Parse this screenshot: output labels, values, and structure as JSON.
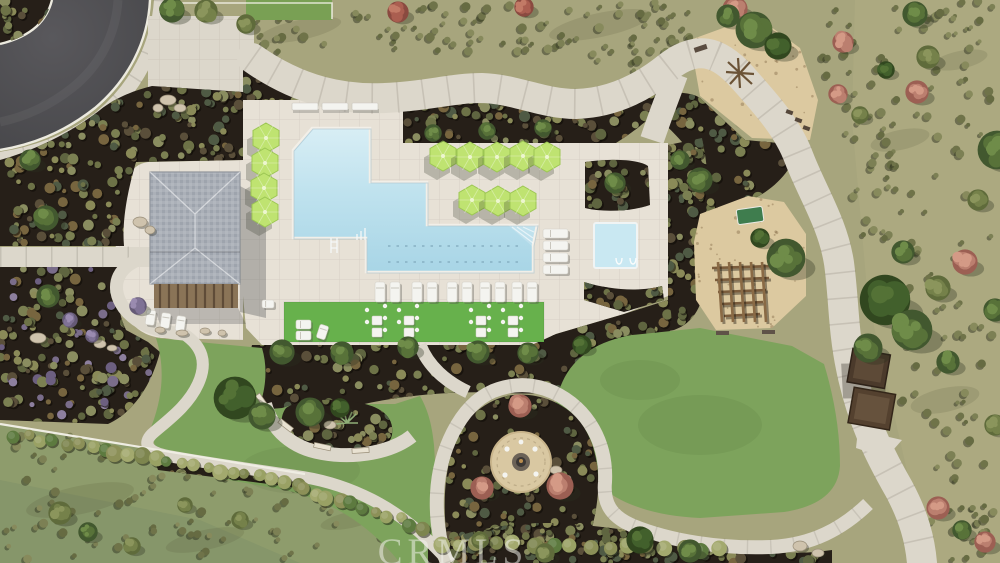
{
  "watermark": {
    "text": "CRMLS"
  },
  "scene": {
    "title": "Community amenity area - aerial site plan rendering",
    "setting": "Overhead 3D architectural rendering of a neighborhood recreation center",
    "features": [
      {
        "name": "swimming-pool",
        "label": "L-shaped swimming pool with two dashed lap lanes and entry steps"
      },
      {
        "name": "spa",
        "label": "Square spa with two handrails beside the lap pool"
      },
      {
        "name": "pool-deck",
        "label": "Light travertine pool deck"
      },
      {
        "name": "cabana",
        "label": "Pool building with gray hip roof and wood pergola"
      },
      {
        "name": "umbrellas",
        "label": "Lime-green hexagonal patio umbrellas",
        "count": 12
      },
      {
        "name": "lounge-chairs",
        "label": "White chaise lounges, benches and cafe tables"
      },
      {
        "name": "turf-lounge",
        "label": "Bright artificial-turf seating strip with white furniture"
      },
      {
        "name": "playground-upper",
        "label": "Wood-chip tot lot with play equipment"
      },
      {
        "name": "playground-lower",
        "label": "Wood-chip playground with log climbing structure and green game table"
      },
      {
        "name": "fire-pit",
        "label": "Round decomposed-granite fire pit plaza flanked by pink trees"
      },
      {
        "name": "seating-island",
        "label": "Half-ring walkway around planted island with benches"
      },
      {
        "name": "shade-structure",
        "label": "Two brown shade canopies beside the east walkway"
      },
      {
        "name": "lawns",
        "label": "Open green lawns"
      },
      {
        "name": "walkways",
        "label": "Curving concrete walkways with score joints"
      },
      {
        "name": "street",
        "label": "Asphalt street corner with white curb, corner planter and sidewalk"
      },
      {
        "name": "planting-beds",
        "label": "Dark mulch planting beds densely dotted with shrubs"
      },
      {
        "name": "meadow",
        "label": "Olive open space with scattered shrubs, green and pink trees"
      },
      {
        "name": "boundary-fence",
        "label": "Thin white boundary fence with shrub hedge row"
      }
    ]
  },
  "palette": {
    "meadow": "#a7a57d",
    "meadow_green": "#8e9c6c",
    "lawn": "#7da35c",
    "turf": "#67b14c",
    "mulch": "#261f18",
    "deck": "#e7e1d6",
    "path": "#dcd7cb",
    "road": "#4c4b4d",
    "curb": "#eceadf",
    "water_top": "#d8eef5",
    "water_deep": "#a8d5e6",
    "spa_water": "#c9e8f2",
    "sand": "#dcc9a0",
    "umbrella": "#bfe371",
    "umbrella_edge": "#9cc653",
    "roof": "#a7adb4",
    "roof_dark": "#9399a2",
    "pergola": "#8a7457",
    "furniture": "#f4f4f0",
    "fence": "#efede3",
    "fire_plaza": "#d9c8a2",
    "watermark_color": "rgba(244,243,238,0.52)"
  }
}
